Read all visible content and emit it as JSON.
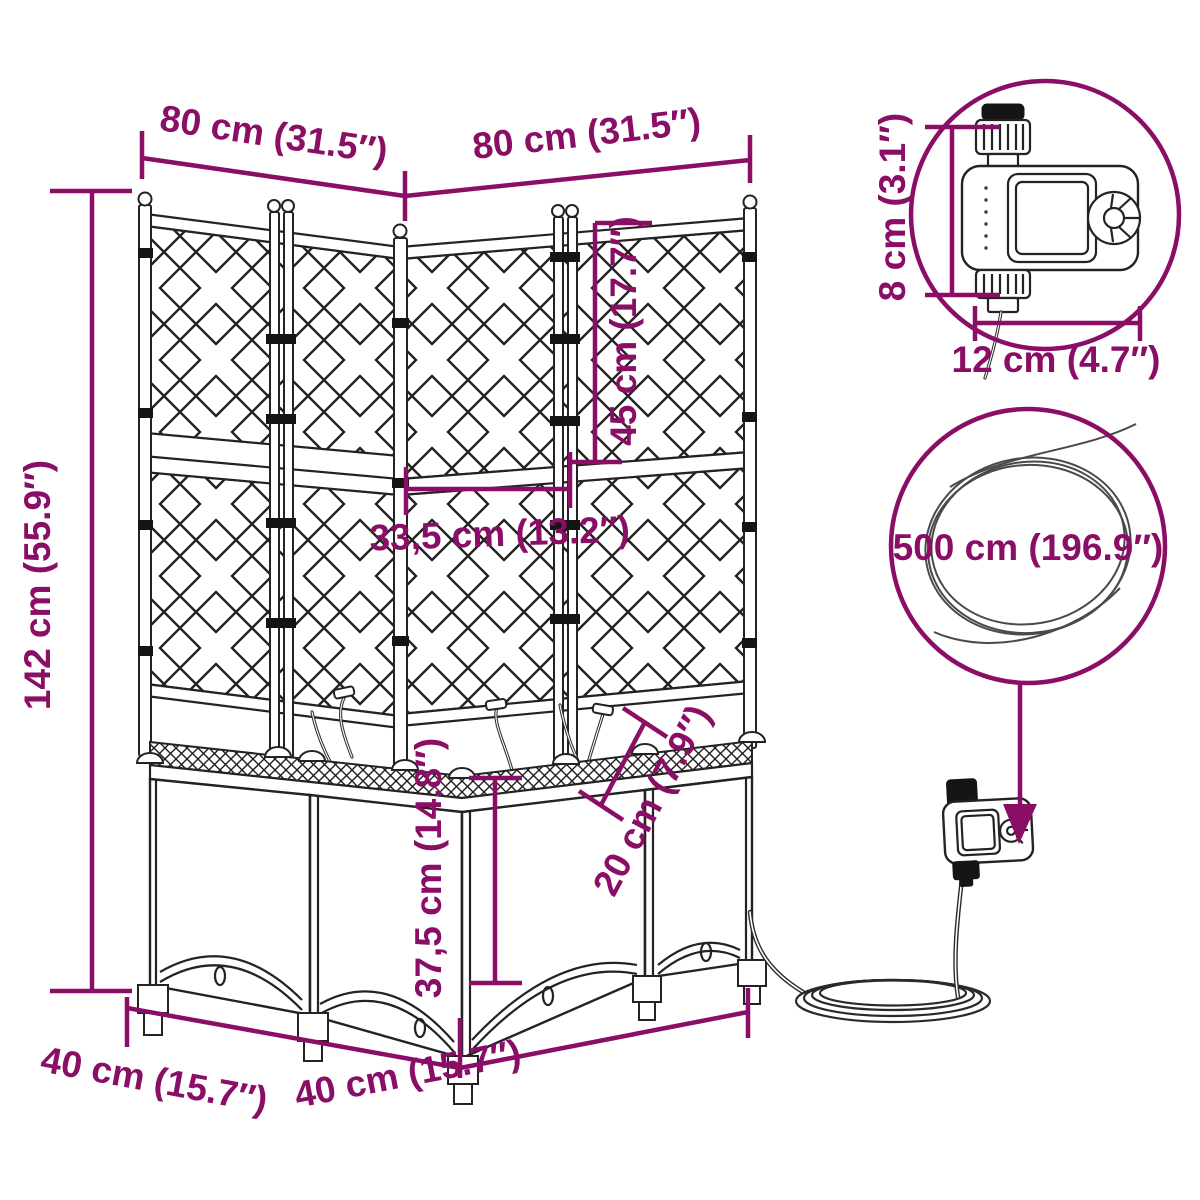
{
  "colors": {
    "accent": "#8a0d66",
    "ink": "#232323",
    "background": "#ffffff"
  },
  "product": "corner planter with trellis and irrigation timer",
  "annotations": {
    "width_left": "80 cm (31.5″)",
    "width_right": "80 cm (31.5″)",
    "total_height": "142 cm (55.9″)",
    "trellis_height": "45 cm (17.7″)",
    "trellis_width": "33,5 cm (13.2″)",
    "planter_height": "37,5 cm (14.8″)",
    "planter_depth": "20 cm (7.9″)",
    "base_left": "40 cm (15.7″)",
    "base_right": "40 cm (15.7″)",
    "timer_height": "8 cm (3.1″)",
    "timer_width": "12 cm (4.7″)",
    "hose_length": "500 cm (196.9″)"
  }
}
